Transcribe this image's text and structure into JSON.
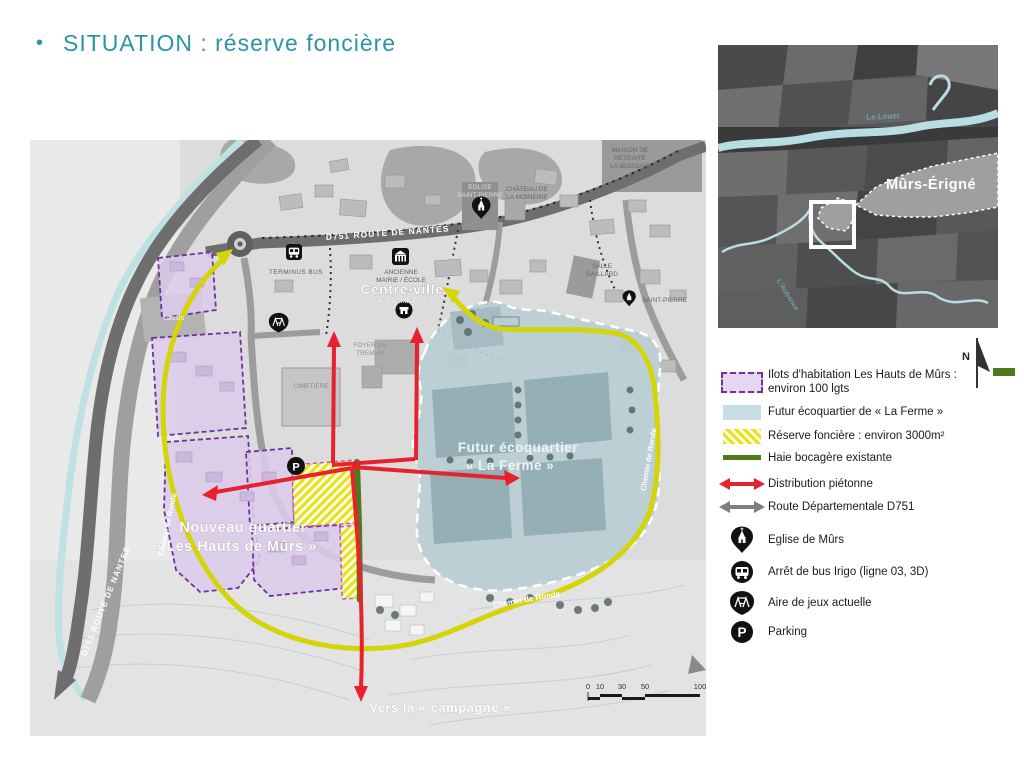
{
  "title": {
    "bullet": "•",
    "text": "SITUATION : réserve foncière"
  },
  "map": {
    "d751_top": "D751  ROUTE DE NANTES",
    "d751_left": "D751  ROUTE DE NANTES",
    "terminus_bus": "TERMINUS BUS",
    "mairie": [
      "ANCIENNE",
      "MAIRIE / ÉCOLE"
    ],
    "centre_ville": "Centre-ville",
    "commerce": "LE COMMERCE",
    "eglise": [
      "EGLISE",
      "SAINT-PIERRE"
    ],
    "chateau": [
      "CHÂTEAU DE",
      "LA MOINERIE"
    ],
    "maison_retraite": [
      "MAISON DE",
      "RETRAITE",
      "LA BUISSAIE"
    ],
    "salle_gaillard": [
      "SALLE",
      "GAILLARD"
    ],
    "saint_pierre": "SAINT-PIERRE",
    "foyer": [
      "FOYER DE",
      "TREMUR"
    ],
    "cimetiere": "CIMETIÈRE",
    "bassin": "bassin",
    "ecoquartier": [
      "Futur écoquartier",
      "« La Ferme »"
    ],
    "nouveau_quartier": [
      "Nouveau quartier",
      "« Les Hauts de Mûrs »"
    ],
    "campagne": "Vers la « campagne »",
    "chemin_de_ronde": "Chemin de Ronde",
    "parking_glyph": "P",
    "scalebar": [
      "0",
      "10",
      "30",
      "50",
      "100"
    ]
  },
  "inset": {
    "le_louet": "Le Louet",
    "town": "Mûrs-Érigné",
    "aubance": "L'Aubance",
    "north": "N"
  },
  "legend": {
    "items": [
      {
        "icon": "purple-dashed-swatch",
        "lines": [
          "Ilots d'habitation Les Hauts de Mûrs :",
          "environ 100 lgts"
        ]
      },
      {
        "icon": "blue-swatch",
        "lines": [
          "Futur écoquartier de « La Ferme »"
        ]
      },
      {
        "icon": "yellow-hatch-swatch",
        "lines": [
          "Réserve foncière : environ 3000m²"
        ]
      },
      {
        "icon": "green-line-swatch",
        "lines": [
          "Haie bocagère existante"
        ]
      },
      {
        "icon": "red-double-arrow",
        "lines": [
          "Distribution piétonne"
        ]
      },
      {
        "icon": "gray-double-arrow",
        "lines": [
          "Route Départementale D751"
        ]
      },
      {
        "icon": "church-icon",
        "lines": [
          "Eglise de Mûrs"
        ]
      },
      {
        "icon": "bus-icon",
        "lines": [
          "Arrêt de bus Irigo (ligne 03, 3D)"
        ]
      },
      {
        "icon": "playground-icon",
        "lines": [
          "Aire de jeux actuelle"
        ]
      },
      {
        "icon": "parking-icon",
        "lines": [
          "Parking"
        ],
        "glyph": "P"
      }
    ]
  },
  "colors": {
    "title_teal": "#2d93a6",
    "purple_fill": "#dccbe9",
    "purple_border": "#7030a0",
    "blue_fill": "#b9ced3",
    "yellow_hatch": "#e3e316",
    "green_haie": "#4f7a1c",
    "red_arrow": "#e8212e",
    "road_gray": "#6e6e6e",
    "water_blue": "#bfe0e4",
    "chemin_yellow": "#d4d408"
  }
}
